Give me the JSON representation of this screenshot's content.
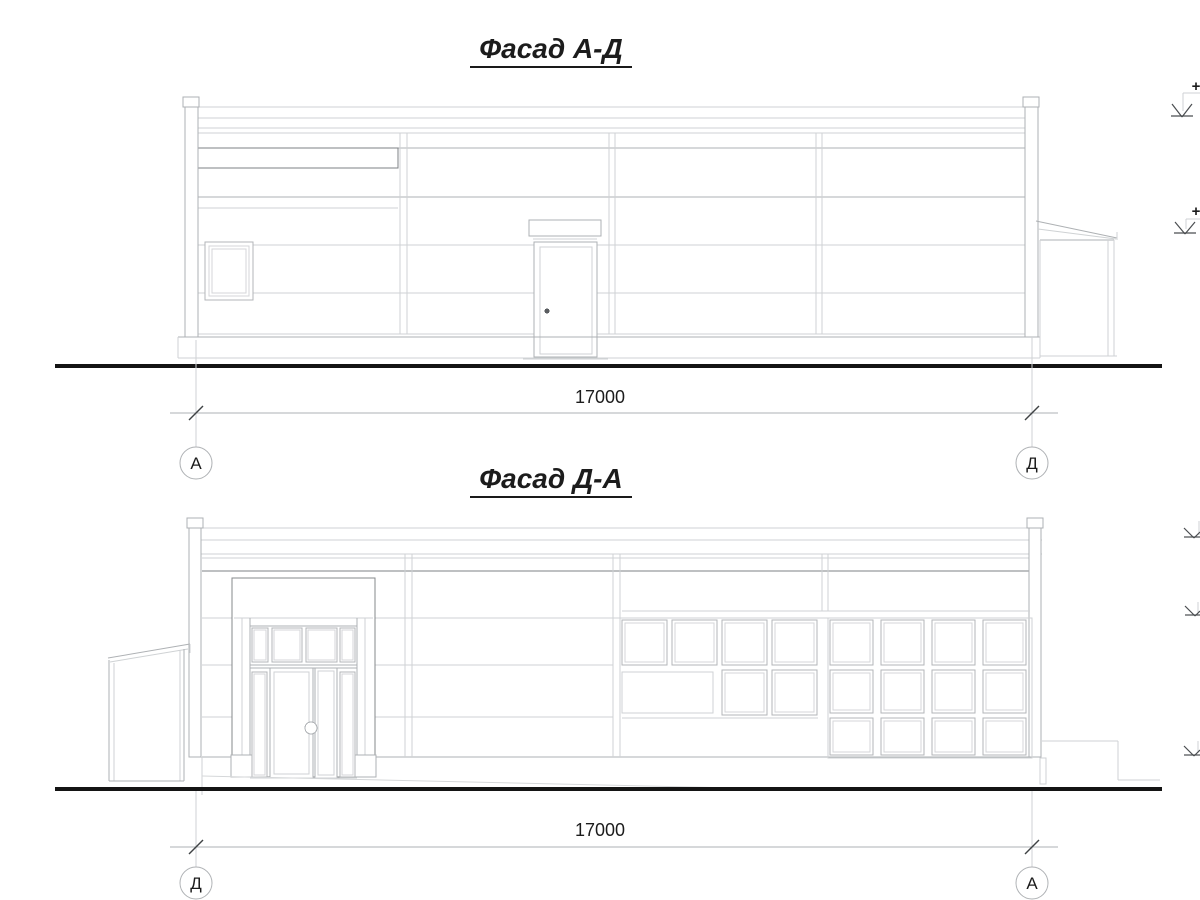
{
  "facade_ad": {
    "title": "Фасад А-Д",
    "dimension_label": "17000",
    "axis_left_label": "А",
    "axis_right_label": "Д",
    "elevation_marks": [
      {
        "sign": "+"
      },
      {
        "sign": "+"
      }
    ]
  },
  "facade_da": {
    "title": "Фасад Д-А",
    "dimension_label": "17000",
    "axis_left_label": "Д",
    "axis_right_label": "А",
    "window_grids": [
      {
        "cols": [
          622,
          672,
          722,
          772
        ],
        "w": 45,
        "rows": [
          {
            "y": 620,
            "h": 45
          }
        ]
      },
      {
        "cols": [
          722,
          772
        ],
        "w": 45,
        "rows": [
          {
            "y": 670,
            "h": 45
          }
        ]
      },
      {
        "cols": [
          830,
          881,
          932,
          983
        ],
        "w": 43,
        "rows": [
          {
            "y": 620,
            "h": 45
          },
          {
            "y": 670,
            "h": 43
          },
          {
            "y": 718,
            "h": 37
          }
        ]
      }
    ]
  },
  "colors": {
    "line_light": "#cfd2d4",
    "line_mid": "#aeb1b4",
    "line_dark": "#7d8184",
    "ground": "#141414",
    "text": "#1c1c1c"
  }
}
